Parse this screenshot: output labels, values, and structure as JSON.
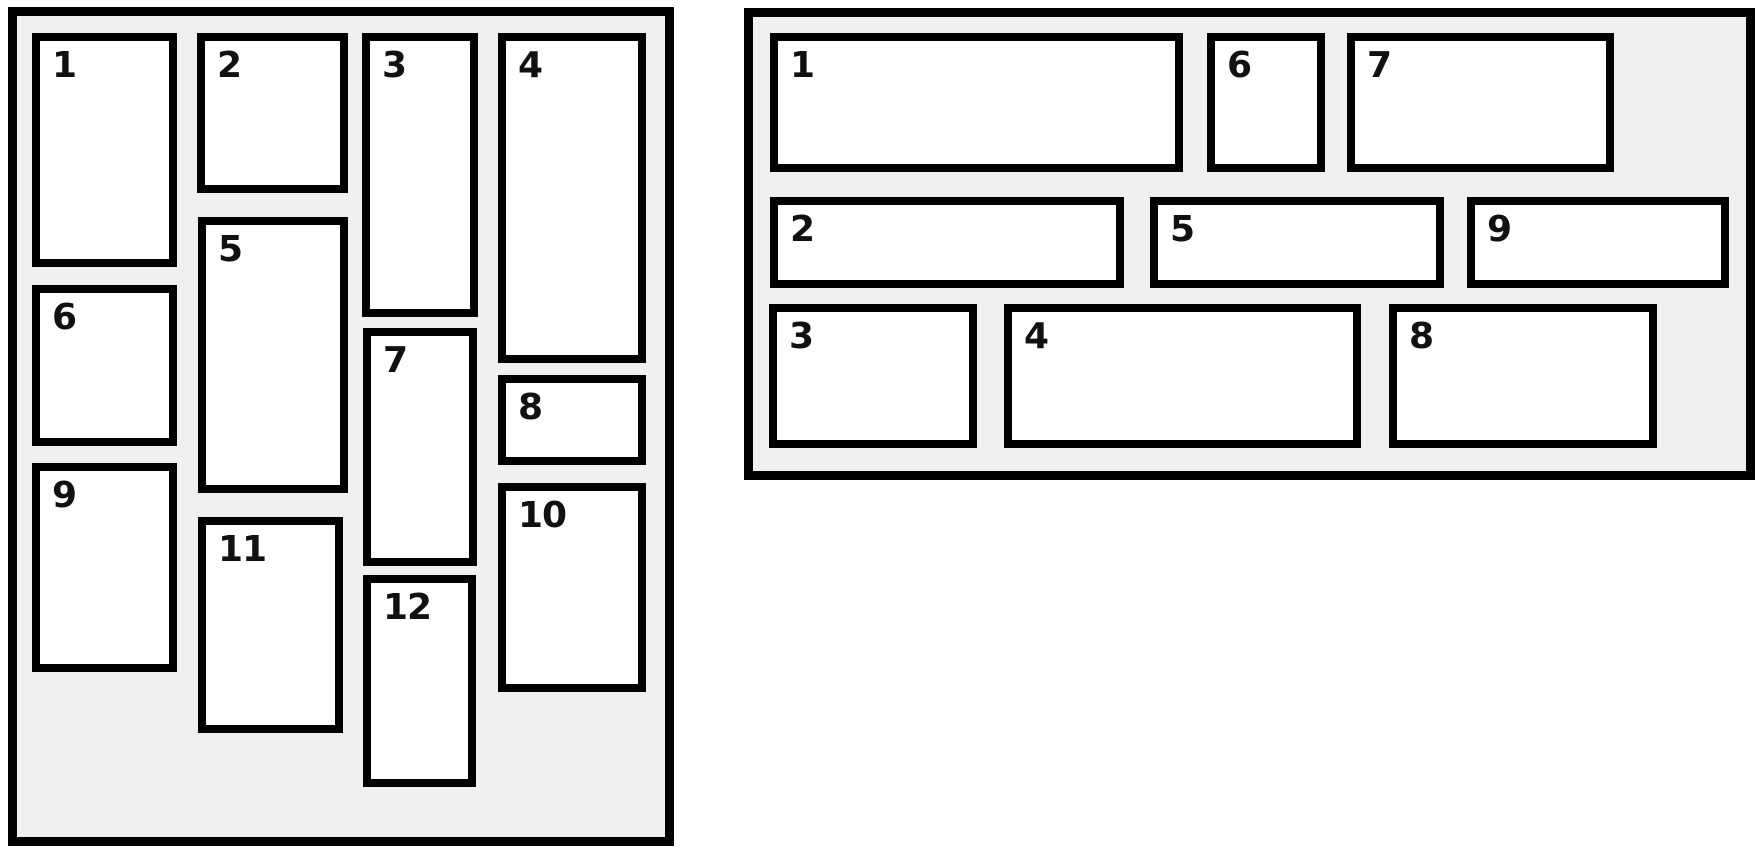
{
  "colors": {
    "page_background": "#ffffff",
    "panel_background": "#f0f0f0",
    "border": "#000000",
    "item_background": "#ffffff",
    "item_number": "#111111"
  },
  "panels": {
    "left": {
      "name": "vertical-masonry",
      "items": [
        "1",
        "2",
        "3",
        "4",
        "5",
        "6",
        "7",
        "8",
        "9",
        "10",
        "11",
        "12"
      ]
    },
    "right": {
      "name": "horizontal-masonry",
      "items": [
        "1",
        "2",
        "3",
        "4",
        "5",
        "6",
        "7",
        "8",
        "9"
      ]
    }
  }
}
